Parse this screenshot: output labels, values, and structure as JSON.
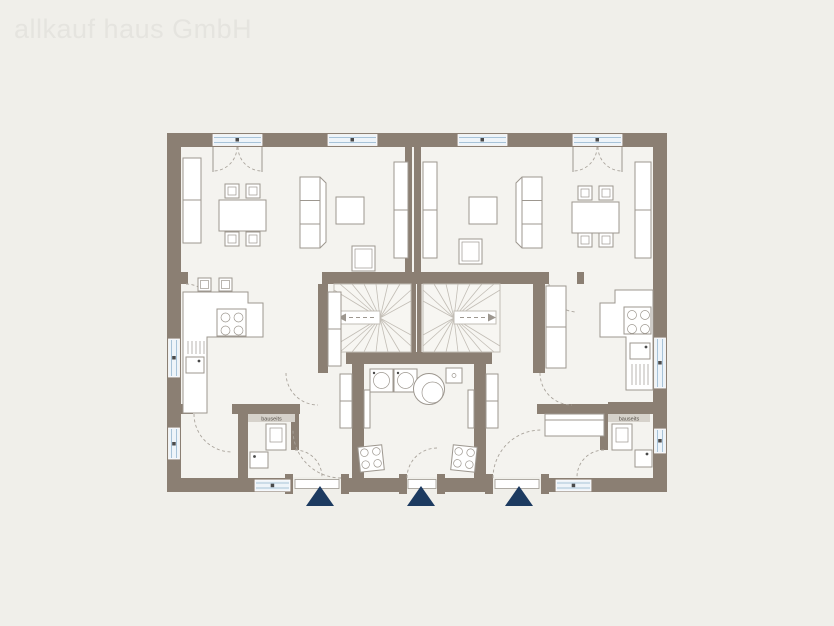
{
  "watermark": {
    "text": "allkauf haus GmbH"
  },
  "theme": {
    "background": "#f0efea",
    "floor": "#f4f3ef",
    "wall": "#8b7f73",
    "furniture_outline": "#9d978f",
    "stair_line": "#c2bdb5",
    "window_glass": "#eef4f9",
    "window_frame": "#a8c3d8",
    "window_dot": "#4a4a4a",
    "door_arc": "#aaa49c",
    "entrance_marker": "#1c3a60",
    "watermark_color": "#e5e4df",
    "label_bg": "#d6d2cb",
    "label_color": "#554f48"
  },
  "floorplan": {
    "description": "Ground floor plan of a duplex house: two mirrored living units, central shared utility room, twin winder staircases, three entrances marked with triangles",
    "entrance_count": 3,
    "units": {
      "left": {
        "bath_label": "bauseits",
        "rooms": [
          "living-dining",
          "kitchen",
          "hall",
          "storage-room",
          "shower-wc"
        ],
        "furniture": [
          "wardrobe",
          "dining-table",
          "chairs",
          "sofa",
          "side-table",
          "armchair",
          "shelf",
          "bar-stools",
          "kitchen-counter",
          "cooktop",
          "kitchen-sink",
          "toilet",
          "washbasin"
        ]
      },
      "right": {
        "bath_label": "bauseits",
        "rooms": [
          "living-dining",
          "kitchen",
          "hall",
          "storage-room",
          "shower-wc"
        ],
        "furniture": [
          "wardrobe",
          "dining-table",
          "chairs",
          "sofa",
          "side-table",
          "armchair",
          "shelf",
          "kitchen-counter",
          "cooktop",
          "kitchen-sink",
          "sideboard",
          "toilet",
          "washbasin"
        ]
      },
      "shared": {
        "rooms": [
          "utility-room",
          "stairwell-left",
          "stairwell-right"
        ],
        "furniture": [
          "washing-machine",
          "washing-machine",
          "water-tank",
          "meter-box",
          "heating-unit",
          "heating-unit"
        ]
      }
    }
  }
}
